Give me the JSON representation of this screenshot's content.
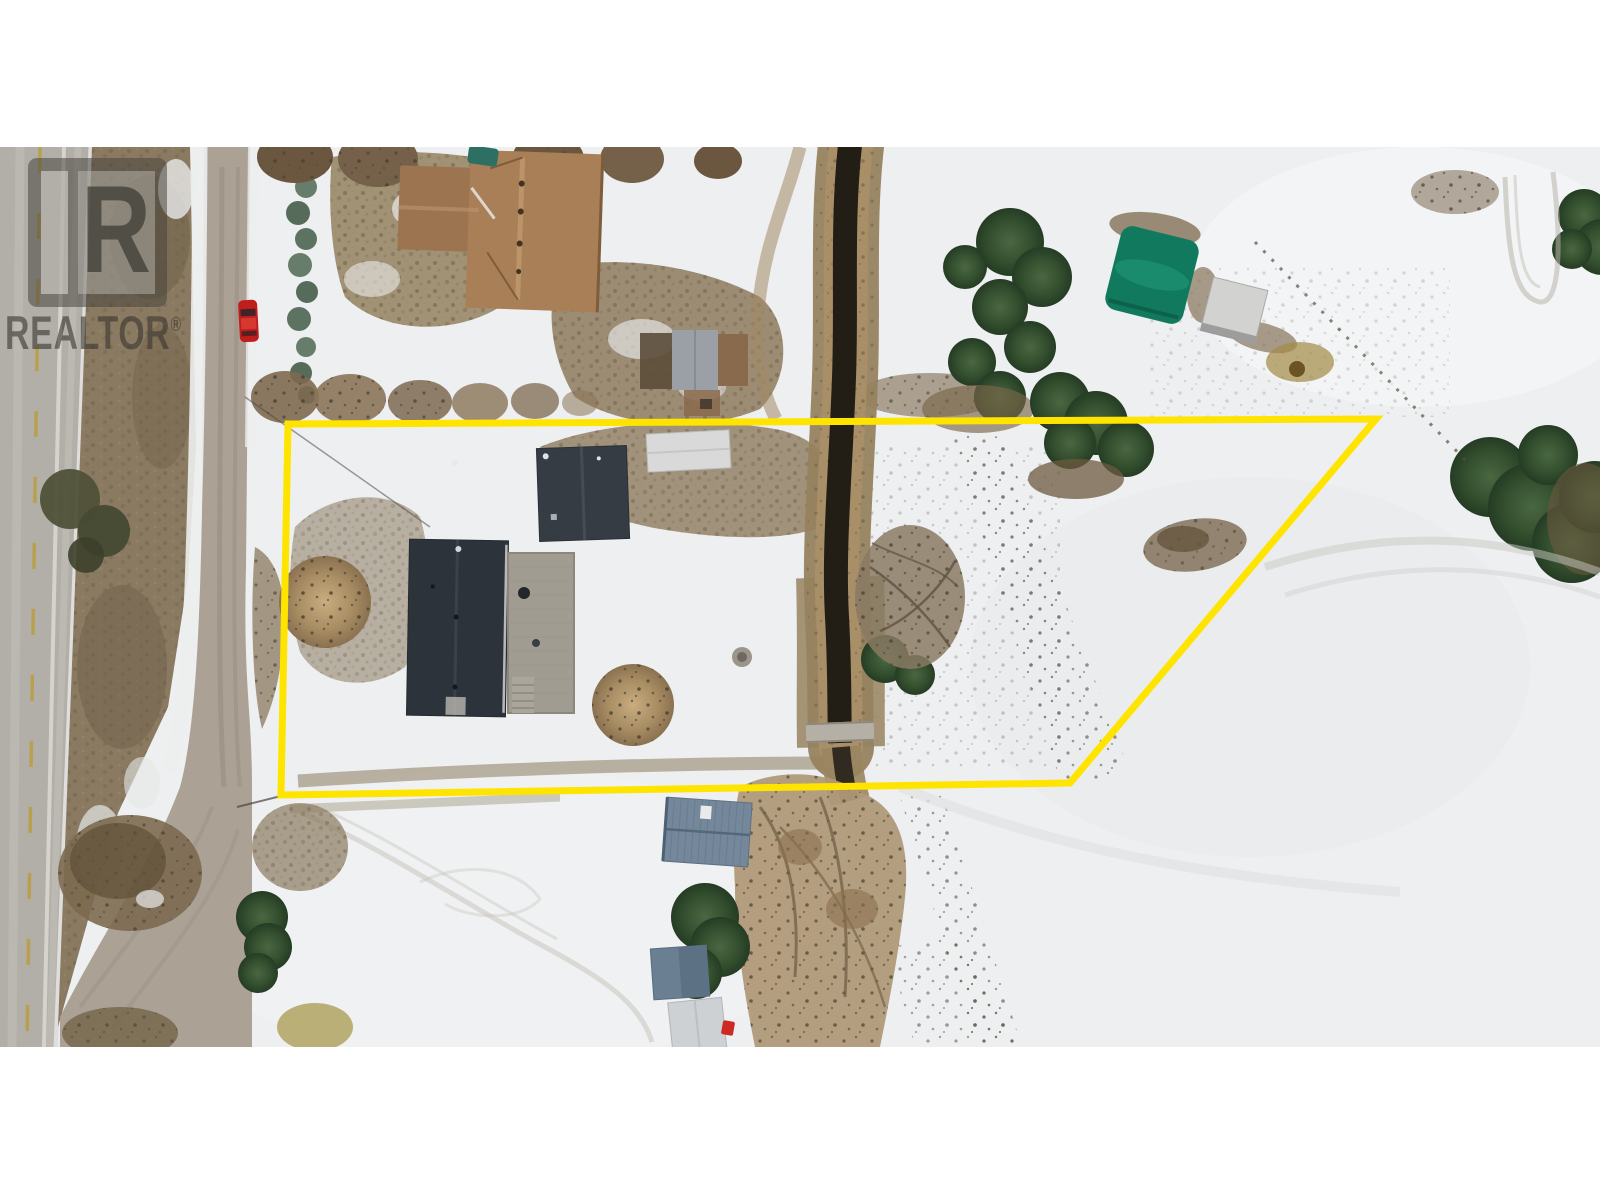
{
  "watermark": {
    "logo_letter": "R",
    "brand_text": "REALTOR",
    "registered_symbol": "®"
  },
  "colors": {
    "page_background": "#ffffff",
    "boundary": "#ffe400",
    "snow": "#edeff0",
    "highway": "#b2aea8",
    "highway_center_line": "#b99f45",
    "highway_edge_line": "#d9d6d0",
    "gravel_road": "#aba295",
    "median_grass": "#8b7a62",
    "creek_water": "#221e16",
    "creek_bank": "#97825f",
    "main_house_roof": "#2d333b",
    "dark_shed_roof": "#363c44",
    "brown_house_roof": "#a87f56",
    "gray_shed_roof": "#9aa0a5",
    "white_shed_roof": "#d8d9d8",
    "deck": "#a19c92",
    "blue_house_roof": "#75889b",
    "blue_shed_roof": "#6b7f92",
    "bottom_white_shed_roof": "#cdd1d4",
    "green_quonset": "#117a5e",
    "white_trailer": "#d2d3d1",
    "red_car": "#c01d1d",
    "conifer": "#34502f",
    "bare_tree": "#b29a78"
  },
  "scene": {
    "description": "Winter aerial drone photograph of a rural lot outlined in yellow, bordered by a highway and gravel road on the left and a creek running through the parcel",
    "elements": [
      {
        "name": "property-boundary-outline",
        "label": "Yellow surveyed lot outline (trapezoid)"
      },
      {
        "name": "highway",
        "label": "Paved highway with dashed centre line, left edge"
      },
      {
        "name": "median-strip",
        "label": "Brown grass median between highway and gravel road"
      },
      {
        "name": "gravel-road",
        "label": "Gravel road curving to meet highway at bottom left"
      },
      {
        "name": "red-car",
        "label": "Red car parked on gravel road"
      },
      {
        "name": "brown-house",
        "label": "Brown hip-roof house, top left (neighbouring lot)"
      },
      {
        "name": "gray-shed",
        "label": "Grey metal shed with brown deck, above boundary"
      },
      {
        "name": "white-shed",
        "label": "White flat shed just inside north boundary"
      },
      {
        "name": "dark-shed",
        "label": "Dark charcoal detached garage inside lot"
      },
      {
        "name": "main-house",
        "label": "Dark charcoal main house with wooden deck and stairs"
      },
      {
        "name": "blue-house",
        "label": "Blue-grey metal roof house south of the lot"
      },
      {
        "name": "blue-shed",
        "label": "Small blue-grey shed, bottom middle"
      },
      {
        "name": "bottom-white-shed",
        "label": "White shed at bottom photo edge"
      },
      {
        "name": "green-quonset",
        "label": "Green quonset / tarp shelter, top right"
      },
      {
        "name": "white-trailer",
        "label": "White trailer beside quonset"
      },
      {
        "name": "creek",
        "label": "Dark creek with brown banks flowing north-south"
      },
      {
        "name": "creek-culvert",
        "label": "Light culvert crossing over creek"
      },
      {
        "name": "conifer-trees",
        "label": "Dark green conifer clusters"
      },
      {
        "name": "bare-trees",
        "label": "Tan leafless deciduous trees and brush"
      },
      {
        "name": "roadside-hedge",
        "label": "Row of small junipers along gravel road"
      },
      {
        "name": "snow-tracks",
        "label": "Tire and foot tracks in snow"
      }
    ]
  }
}
